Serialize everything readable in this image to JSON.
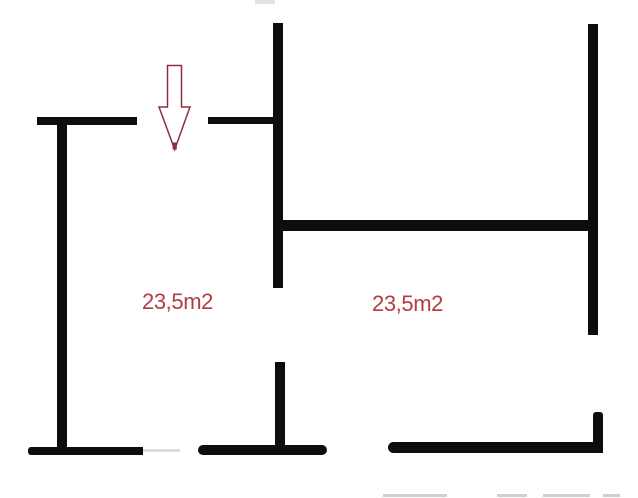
{
  "floor_plan": {
    "type": "floor-plan",
    "rooms": [
      {
        "id": "room-left",
        "area_label": "23,5m2"
      },
      {
        "id": "room-right",
        "area_label": "23,5m2"
      }
    ],
    "entrance_arrow": {
      "icon": "down-arrow-icon",
      "direction": "down"
    },
    "colors": {
      "background": "#ffffff",
      "wall": "#0d0d0d",
      "wall_faint": "#d0d0d0",
      "label_text": "#b23b44",
      "arrow_outline": "#8e2f3e"
    }
  }
}
